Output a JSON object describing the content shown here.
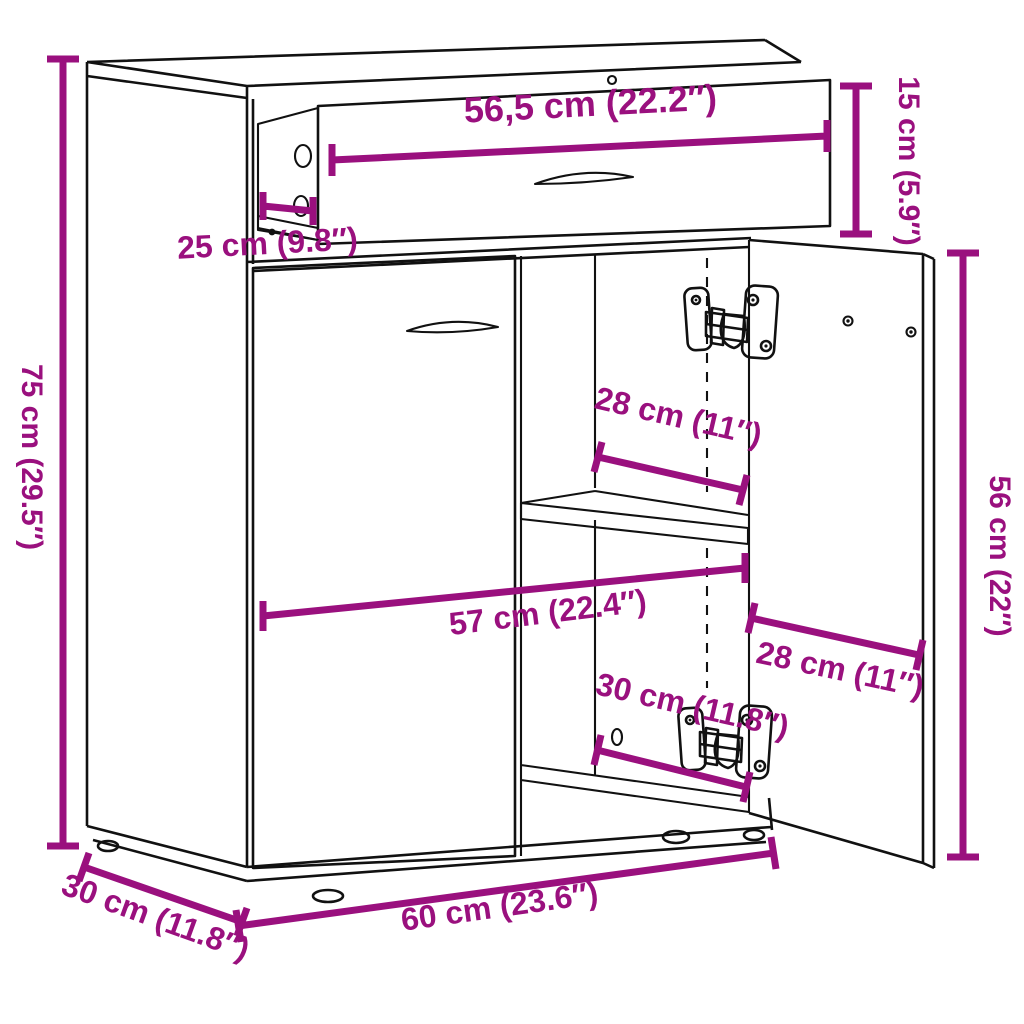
{
  "diagram": {
    "type": "furniture-dimension-diagram",
    "subject": "sideboard with pulled-out drawer and open door",
    "colors": {
      "dimension": "#9A107E",
      "line": "#111111",
      "background": "#FFFFFF"
    },
    "dimensions": [
      {
        "id": "drawer-width",
        "label": "56,5 cm (22.2″)"
      },
      {
        "id": "drawer-height",
        "label": "15 cm (5.9″)"
      },
      {
        "id": "drawer-depth",
        "label": "25 cm (9.8″)"
      },
      {
        "id": "cabinet-height",
        "label": "75 cm (29.5″)"
      },
      {
        "id": "compartment-width",
        "label": "28 cm (11″)"
      },
      {
        "id": "interior-width",
        "label": "57 cm (22.4″)"
      },
      {
        "id": "door-width",
        "label": "28 cm (11″)"
      },
      {
        "id": "lower-compartment-height",
        "label": "30 cm (11.8″)"
      },
      {
        "id": "door-height",
        "label": "56 cm (22″)"
      },
      {
        "id": "cabinet-width",
        "label": "60 cm (23.6″)"
      },
      {
        "id": "cabinet-depth",
        "label": "30 cm (11.8″)"
      }
    ]
  }
}
